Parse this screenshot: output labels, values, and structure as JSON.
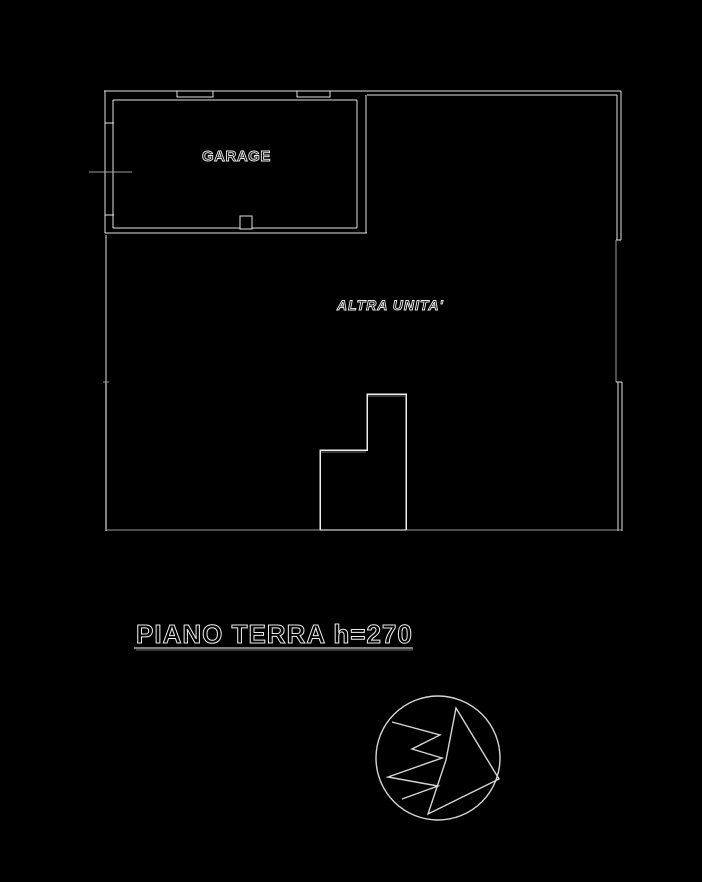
{
  "colors": {
    "background": "#000000",
    "wall_line": "#e2e2e2",
    "dim_line": "#9a9a9a",
    "text_outline": "#ececec"
  },
  "labels": {
    "garage": "GARAGE",
    "other_unit": "ALTRA UNITA'",
    "floor_title": "PIANO TERRA h=270"
  },
  "icons": {
    "north_arrow": "north-arrow-icon"
  }
}
